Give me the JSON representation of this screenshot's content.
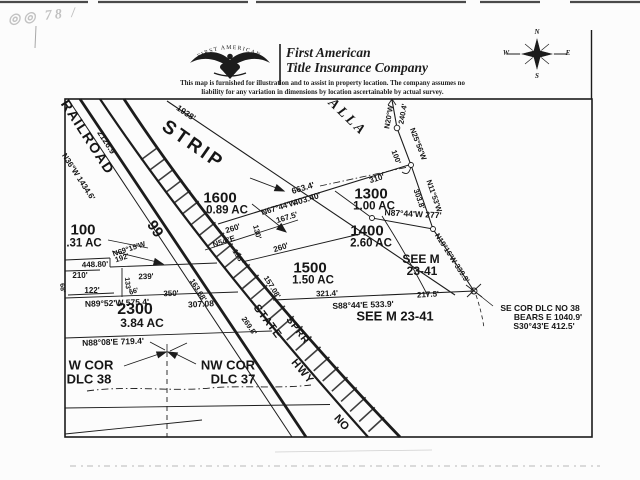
{
  "colors": {
    "ink": "#1c1c1c",
    "paper": "#fcfcfc",
    "stamp": "#c2c2c2"
  },
  "header": {
    "stamp_text": "◎◎ 78 /",
    "logo_arch_text": "FIRST  AMERICAN",
    "company_line1": "First American",
    "company_line2": "Title Insurance Company",
    "disclaimer_line1": "This map is furnished for illustration and to assist in property location.  The company assumes no",
    "disclaimer_line2": "liability for any variation in dimensions by location ascertainable by actual survey."
  },
  "compass": {
    "n": "N",
    "s": "S",
    "e": "E",
    "w": "W"
  },
  "map": {
    "labels": [
      {
        "n": "street-alla",
        "t": "ALLA",
        "x": 347,
        "y": 118,
        "r": 44,
        "s": 14,
        "f": "serif",
        "i": 1,
        "ls": 3
      },
      {
        "n": "road-railroad",
        "t": "RAILROAD",
        "x": 88,
        "y": 137,
        "r": 57,
        "s": 14,
        "ls": 1.5
      },
      {
        "n": "dim-2126-9",
        "t": "2126.9'",
        "x": 107,
        "y": 143,
        "r": 57,
        "s": 8.5
      },
      {
        "n": "bearing-n36w-1434-6",
        "t": "N36°W 1434.6'",
        "x": 78,
        "y": 177,
        "r": 57,
        "s": 8
      },
      {
        "n": "label-strip",
        "t": "STRIP",
        "x": 193,
        "y": 145,
        "r": 35,
        "s": 19,
        "ls": 3
      },
      {
        "n": "dim-1938",
        "t": "1938'",
        "x": 186,
        "y": 113,
        "r": 34,
        "s": 8.5
      },
      {
        "n": "road-99",
        "t": "99",
        "x": 155,
        "y": 229,
        "r": 56,
        "s": 15
      },
      {
        "n": "parcel-1600-number",
        "t": "1600",
        "x": 220,
        "y": 198,
        "s": 15
      },
      {
        "n": "parcel-1600-acreage",
        "t": "0.89 AC",
        "x": 227,
        "y": 211,
        "s": 11.5
      },
      {
        "n": "dim-663-4",
        "t": "663.4'",
        "x": 303,
        "y": 188,
        "r": -17,
        "s": 8.5
      },
      {
        "n": "dim-403-40",
        "t": "403.40'",
        "x": 307,
        "y": 199,
        "r": -17,
        "s": 8.5
      },
      {
        "n": "bearing-n67-44w",
        "t": "N67°44'W",
        "x": 279,
        "y": 208,
        "r": -17,
        "s": 8
      },
      {
        "n": "dim-167-5",
        "t": "167.5'",
        "x": 287,
        "y": 218,
        "r": -17,
        "s": 8
      },
      {
        "n": "dim-310",
        "t": "310'",
        "x": 377,
        "y": 179,
        "r": -17,
        "s": 8
      },
      {
        "n": "parcel-1300-number",
        "t": "1300",
        "x": 371,
        "y": 194,
        "s": 15
      },
      {
        "n": "parcel-1300-acreage",
        "t": "1.00 AC",
        "x": 374,
        "y": 207,
        "s": 11.5
      },
      {
        "n": "bearing-n87-44w-277",
        "t": "N87°44'W 277'",
        "x": 413,
        "y": 214,
        "r": 3,
        "s": 8.5
      },
      {
        "n": "bearing-n20w",
        "t": "N20°W",
        "x": 389,
        "y": 117,
        "r": -80,
        "s": 7.5
      },
      {
        "n": "dim-240-4",
        "t": "240.4'",
        "x": 403,
        "y": 114,
        "r": -80,
        "s": 7.5
      },
      {
        "n": "bearing-n25-56w",
        "t": "N25°56'W",
        "x": 418,
        "y": 144,
        "r": 69,
        "s": 7.5
      },
      {
        "n": "dim-100ft",
        "t": "100'",
        "x": 396,
        "y": 157,
        "r": 69,
        "s": 7.5
      },
      {
        "n": "dim-303-8",
        "t": "303.8'",
        "x": 419,
        "y": 199,
        "r": 71,
        "s": 7.5
      },
      {
        "n": "bearing-n11-53w",
        "t": "N11°53'W",
        "x": 434,
        "y": 196,
        "r": 71,
        "s": 7.5
      },
      {
        "n": "parcel-1400-number",
        "t": "1400",
        "x": 367,
        "y": 231,
        "s": 15
      },
      {
        "n": "parcel-1400-acreage",
        "t": "2.60 AC",
        "x": 371,
        "y": 244,
        "s": 11.5
      },
      {
        "n": "note-see-m-upper-1",
        "t": "SEE M",
        "x": 421,
        "y": 259,
        "s": 12
      },
      {
        "n": "note-see-m-upper-2",
        "t": "23-41",
        "x": 422,
        "y": 271,
        "s": 12
      },
      {
        "n": "bearing-n19-16w-339-9",
        "t": "N19°16'W-339.9'",
        "x": 452,
        "y": 258,
        "r": 57,
        "s": 7.5
      },
      {
        "n": "bearing-n54e",
        "t": "N54°E",
        "x": 224,
        "y": 242,
        "r": -18,
        "s": 8
      },
      {
        "n": "dim-260-upper",
        "t": "260'",
        "x": 233,
        "y": 229,
        "r": -18,
        "s": 8
      },
      {
        "n": "dim-130",
        "t": "130'",
        "x": 257,
        "y": 232,
        "r": 75,
        "s": 7.5
      },
      {
        "n": "dim-158",
        "t": "158'",
        "x": 238,
        "y": 256,
        "r": 58,
        "s": 7.5
      },
      {
        "n": "dim-260-lower",
        "t": "260'",
        "x": 281,
        "y": 248,
        "r": -18,
        "s": 8
      },
      {
        "n": "parcel-1500-number",
        "t": "1500",
        "x": 310,
        "y": 268,
        "s": 15
      },
      {
        "n": "parcel-1500-acreage",
        "t": "1.50 AC",
        "x": 313,
        "y": 281,
        "s": 11.5
      },
      {
        "n": "dim-157-08",
        "t": "157.08'",
        "x": 272,
        "y": 287,
        "r": 58,
        "s": 7.5
      },
      {
        "n": "dim-163-68",
        "t": "163.68'",
        "x": 198,
        "y": 290,
        "r": 58,
        "s": 7.5
      },
      {
        "n": "dim-269-8",
        "t": "269.8'",
        "x": 249,
        "y": 326,
        "r": 55,
        "s": 7.5
      },
      {
        "n": "parcel-100-number",
        "t": "100",
        "x": 83,
        "y": 230,
        "s": 15
      },
      {
        "n": "parcel-100-acreage",
        "t": ".31 AC",
        "x": 84,
        "y": 244,
        "s": 11.5
      },
      {
        "n": "bearing-n69-15w",
        "t": "N69°15'W",
        "x": 129,
        "y": 249,
        "r": -18,
        "s": 7.5
      },
      {
        "n": "dim-192",
        "t": "192'",
        "x": 122,
        "y": 258,
        "r": -18,
        "s": 7.5
      },
      {
        "n": "dim-448-80",
        "t": "448.80'",
        "x": 95,
        "y": 265,
        "r": -2,
        "s": 8
      },
      {
        "n": "dim-210",
        "t": "210'",
        "x": 80,
        "y": 276,
        "s": 8
      },
      {
        "n": "dim-239",
        "t": "239'",
        "x": 146,
        "y": 277,
        "r": -2,
        "s": 8
      },
      {
        "n": "dim-133",
        "t": "133'",
        "x": 127,
        "y": 284,
        "r": 85,
        "s": 7
      },
      {
        "n": "dim-122",
        "t": "122'",
        "x": 92,
        "y": 291,
        "s": 8
      },
      {
        "n": "dim-68",
        "t": "68'",
        "x": 62,
        "y": 288,
        "r": 85,
        "s": 7
      },
      {
        "n": "dim-66",
        "t": "66'",
        "x": 134,
        "y": 292,
        "r": -18,
        "s": 7
      },
      {
        "n": "dim-350",
        "t": "350'",
        "x": 171,
        "y": 294,
        "r": -2,
        "s": 8
      },
      {
        "n": "bearing-n89-52w-575-4",
        "t": "N89°52'W 575.4'",
        "x": 117,
        "y": 303,
        "r": -2,
        "s": 8.5
      },
      {
        "n": "dim-307-08",
        "t": "307.08'",
        "x": 202,
        "y": 304,
        "r": -3,
        "s": 8.5
      },
      {
        "n": "parcel-2300-number",
        "t": "2300",
        "x": 135,
        "y": 310,
        "s": 16
      },
      {
        "n": "parcel-2300-acreage",
        "t": "3.84 AC",
        "x": 142,
        "y": 323,
        "s": 12
      },
      {
        "n": "bearing-n88-08e-719-4",
        "t": "N88°08'E 719.4'",
        "x": 113,
        "y": 342,
        "r": -2,
        "s": 8.5
      },
      {
        "n": "corner-w-cor-1",
        "t": "W COR",
        "x": 91,
        "y": 365,
        "s": 13
      },
      {
        "n": "corner-w-cor-2",
        "t": "DLC 38",
        "x": 89,
        "y": 379,
        "s": 13
      },
      {
        "n": "corner-nw-cor-1",
        "t": "NW COR",
        "x": 228,
        "y": 365,
        "s": 13
      },
      {
        "n": "corner-nw-cor-2",
        "t": "DLC 37",
        "x": 233,
        "y": 379,
        "s": 13
      },
      {
        "n": "road-state",
        "t": "STATE",
        "x": 267,
        "y": 322,
        "r": 53,
        "s": 11,
        "ls": 1
      },
      {
        "n": "road-sprr",
        "t": "SPRR",
        "x": 297,
        "y": 331,
        "r": 53,
        "s": 10,
        "ls": 1
      },
      {
        "n": "road-hwy",
        "t": "HWY",
        "x": 302,
        "y": 372,
        "r": 50,
        "s": 11,
        "ls": 1
      },
      {
        "n": "road-no",
        "t": "NO",
        "x": 341,
        "y": 423,
        "r": 48,
        "s": 11
      },
      {
        "n": "dim-321-4",
        "t": "321.4'",
        "x": 327,
        "y": 294,
        "r": -2,
        "s": 8
      },
      {
        "n": "dim-217-5",
        "t": "217.5'",
        "x": 428,
        "y": 295,
        "r": -3,
        "s": 8
      },
      {
        "n": "bearing-s88-44e-533-9",
        "t": "S88°44'E 533.9'",
        "x": 363,
        "y": 305,
        "r": -2,
        "s": 8.5
      },
      {
        "n": "note-see-m-lower",
        "t": "SEE M 23-41",
        "x": 395,
        "y": 316,
        "s": 13
      },
      {
        "n": "note-se-cor-1",
        "t": "SE COR DLC NO 38",
        "x": 540,
        "y": 308,
        "s": 8.5
      },
      {
        "n": "note-se-cor-2",
        "t": "BEARS E 1040.9'",
        "x": 548,
        "y": 317,
        "s": 8.5
      },
      {
        "n": "note-se-cor-3",
        "t": "S30°43'E 412.5'",
        "x": 544,
        "y": 326,
        "s": 8.5
      }
    ]
  }
}
